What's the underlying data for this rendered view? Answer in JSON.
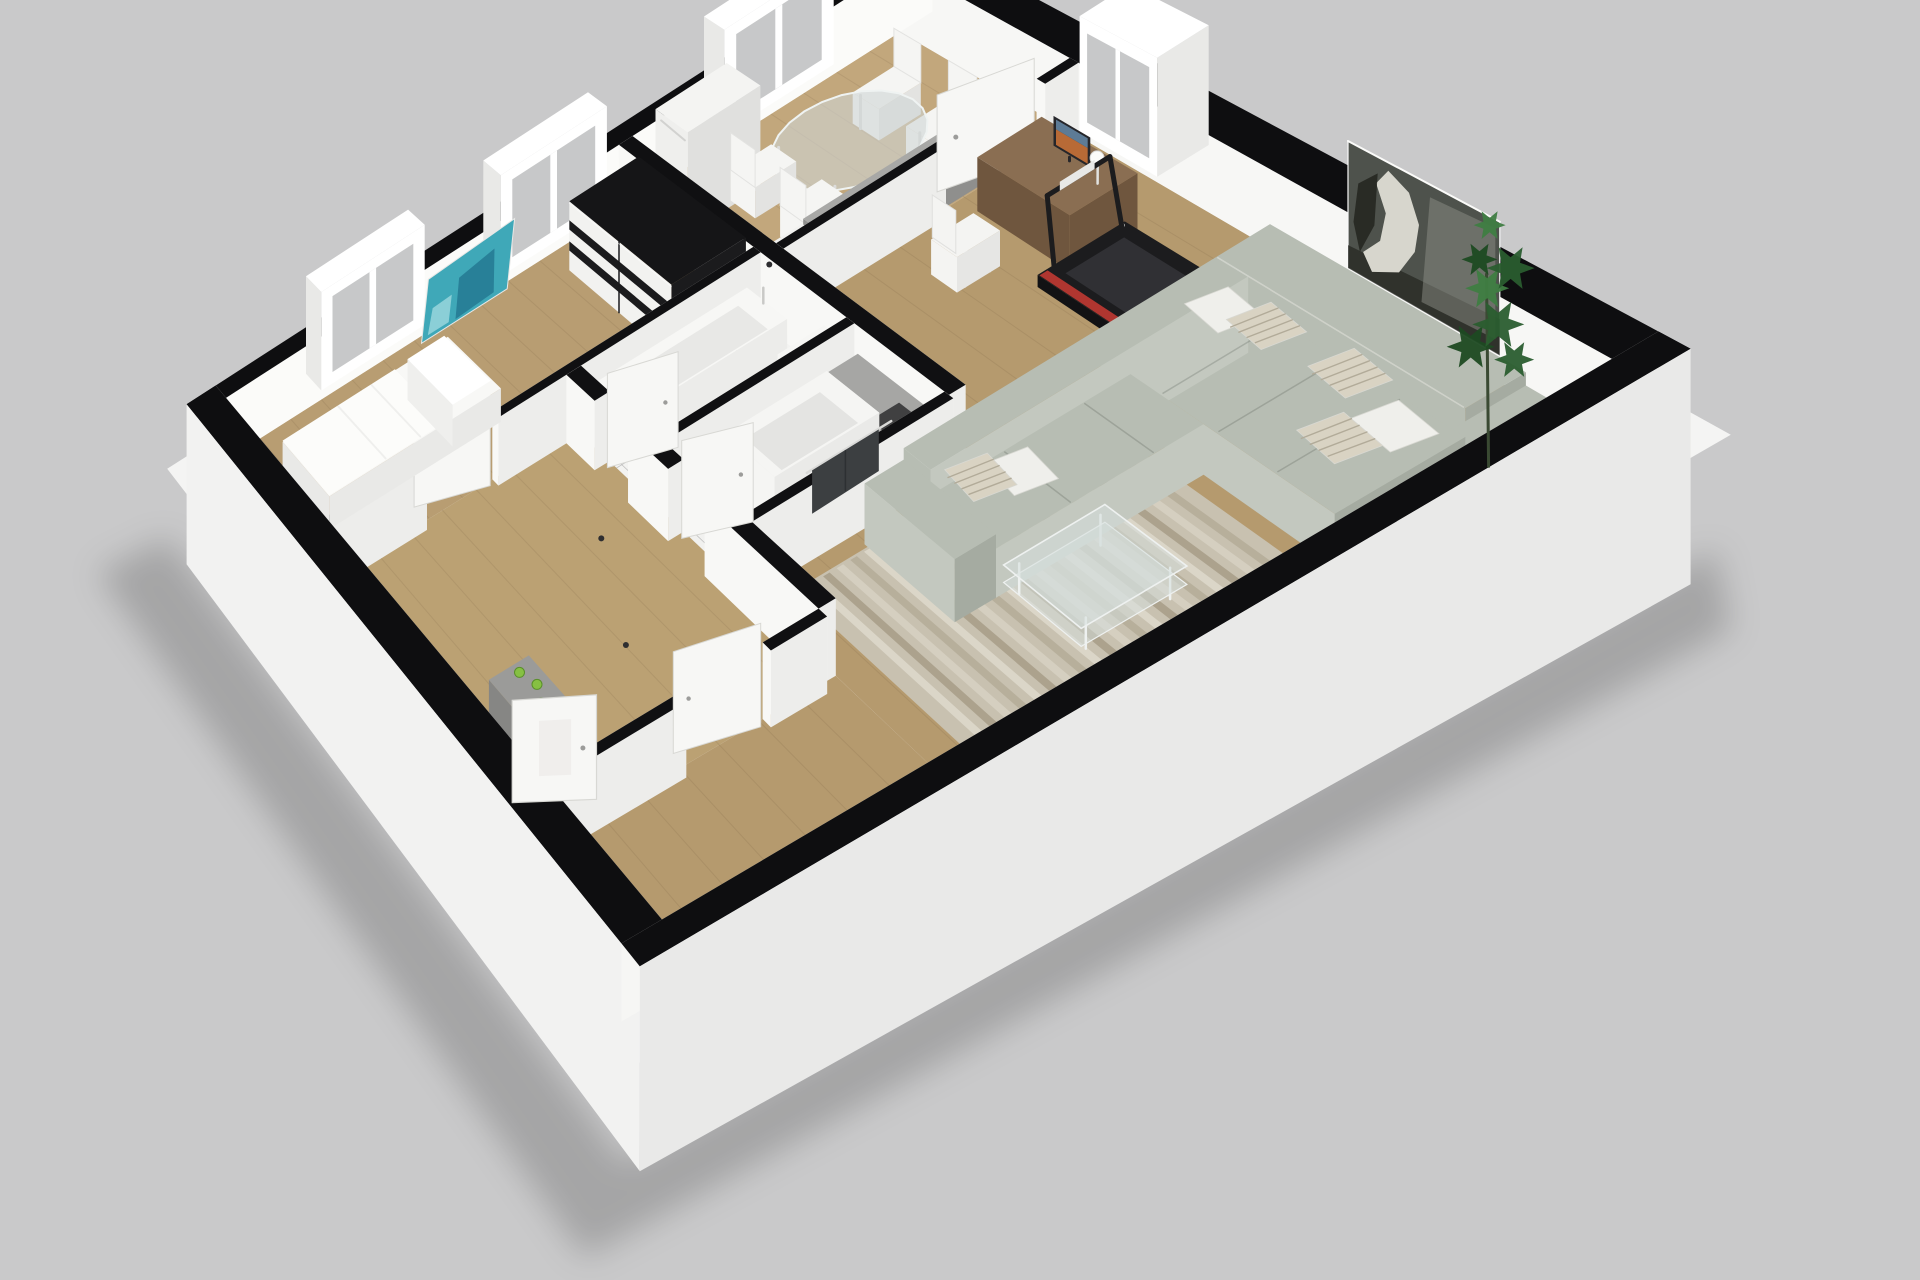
{
  "meta": {
    "scene": "apartment-3d-floor-plan",
    "style": "dollhouse-isometric-render",
    "background": "#c9c9ca"
  },
  "rooms": [
    {
      "name": "living-room",
      "floor": "wood"
    },
    {
      "name": "kitchen-dining",
      "floor": "wood"
    },
    {
      "name": "bedroom",
      "floor": "wood"
    },
    {
      "name": "bathroom",
      "floor": "tile"
    },
    {
      "name": "shower-room",
      "floor": "tile"
    },
    {
      "name": "hallway",
      "floor": "wood"
    }
  ],
  "furniture_by_room": {
    "living-room": [
      "sectional-sofa",
      "pillows",
      "area-rug",
      "coffee-table",
      "treadmill",
      "desk",
      "monitor",
      "desk-lamp",
      "office-chair",
      "horse-painting",
      "potted-plant"
    ],
    "kitchen-dining": [
      "refrigerator",
      "dining-table",
      "dining-chairs",
      "kitchen-counter",
      "kitchen-cabinet"
    ],
    "bedroom": [
      "wardrobe",
      "bed",
      "wall-art-teal"
    ],
    "bathroom": [
      "bathtub",
      "bathroom-sink"
    ],
    "shower-room": [
      "shower",
      "towel",
      "vanity-counter",
      "toilet"
    ],
    "hallway": [
      "entry-shelf",
      "decor-apples",
      "doors"
    ]
  },
  "counts": {
    "windows_nw": 3,
    "windows_ne": 1,
    "doors": 6,
    "pillows": 7,
    "apples": 3
  },
  "palette": {
    "background": "#c9c9ca",
    "wall_top": "#0e0e10",
    "wall_face": "#f8f8f6",
    "wall_face_shade": "#ededeb",
    "glass": "#c7c8c9"
  },
  "objects": {
    "foundation-slab": {
      "color": "#f4f4f3"
    },
    "ground-shadow": {
      "color": "rgba(0,0,0,0.18)"
    },
    "outer-wall-nw": {
      "top": "#0e0e10",
      "inner": "#fbfbf9"
    },
    "outer-wall-ne": {
      "top": "#0e0e10",
      "inner": "#f7f7f5"
    },
    "outer-wall-sw": {
      "top": "#0e0e10",
      "outer": "#f2f2f1",
      "inner": "#f8f8f6"
    },
    "outer-wall-se": {
      "top": "#0e0e10",
      "outer": "#e9e9e8",
      "inner": "#f6f6f4"
    },
    "interior-wall": {
      "top": "#101012",
      "face": "#f8f8f6",
      "shade": "#ededeb"
    },
    "floor-kitchen": {
      "color": "#c2a77c"
    },
    "floor-living": {
      "color": "#b59a6e"
    },
    "floor-bedroom": {
      "color": "#b89d72"
    },
    "floor-hallway": {
      "color": "#bba173"
    },
    "floor-bathroom": {
      "color": "#f3f3f1"
    },
    "floor-shower-room": {
      "color": "#f1f1ef"
    },
    "window": {
      "frame": "#ffffff",
      "glass": "#c7c8c9",
      "edge": "#e9e9e7"
    },
    "door": {
      "panel": "#f7f7f5",
      "edge": "#d8d8d4",
      "handle": "#9c9c9a"
    },
    "refrigerator": {
      "top": "#f4f4f2",
      "front": "#efefed",
      "side": "#e0e0de"
    },
    "dining-table": {
      "glass": "rgba(206,214,213,0.6)",
      "rim": "#eff3f2",
      "leg": "#dcdcda"
    },
    "dining-chair": {
      "color": "#f5f5f3",
      "shade": "#e3e3e1"
    },
    "kitchen-counter": {
      "top": "#a8a8a6",
      "side": "#8f8f8d"
    },
    "kitchen-cabinet": {
      "top": "#f1f1ef",
      "front": "#e8e8e6",
      "panel": "#3a3a3c"
    },
    "desk": {
      "top": "#8a6e52",
      "side": "#6f563e"
    },
    "office-chair": {
      "color": "#f4f4f2",
      "base": "#d9d9d7"
    },
    "monitor": {
      "frame": "#26262a",
      "screen": "#b86a36",
      "screen_top": "#5d7b96"
    },
    "desk-lamp": {
      "color": "#fbfbf9"
    },
    "treadmill": {
      "deck": "#1c1c1e",
      "belt": "#303034",
      "side": "#121214",
      "accent": "#b03630",
      "detail": "#e8e8e6"
    },
    "sectional-sofa": {
      "top": "#b7bdb3",
      "front": "#c3c8bf",
      "side": "#a5aba1",
      "seam": "rgba(40,45,38,0.18)"
    },
    "pillow": {
      "plain": "#efefeb",
      "striped": "#d9d3c3",
      "stripe": "#b2ab99"
    },
    "area-rug": {
      "base": "#c8c1b0",
      "stripes": [
        "#b5ad99",
        "#d6d0c2",
        "#a99f8a",
        "#ddd8cb"
      ]
    },
    "coffee-table": {
      "glass": "rgba(214,222,220,0.55)",
      "frame": "#eef1f0"
    },
    "horse-painting": {
      "canvas": "#4e524c",
      "horse": "#d7d6cd",
      "dark": "#23251f",
      "mid": "#8b8d85"
    },
    "potted-plant": {
      "leaf": "#2a5d2f",
      "leaf_light": "#3f7d42",
      "leaf_dark": "#1d4a22",
      "stem": "#3a4a33"
    },
    "wardrobe": {
      "top": "#151517",
      "front": "#f2f2f0",
      "band": "#1b1b1d",
      "side": "#1b1b1d"
    },
    "bed": {
      "mattress": "#f8f8f6",
      "duvet": "#fcfcfa",
      "side": "#e9e9e7",
      "pillow": "#ffffff"
    },
    "wall-art-teal": {
      "main": "#3fa8b8",
      "dark": "#1f6f8a",
      "light": "#9fd8de"
    },
    "bathtub": {
      "rim": "#f7f7f5",
      "basin": "#e8e8e6",
      "side": "#ececea"
    },
    "bathroom-sink": {
      "color": "#f6f6f4"
    },
    "shower": {
      "wall": "#f5f5f3",
      "inner": "#e4e4e2",
      "side": "#eaeae8"
    },
    "towel": {
      "color": "#3c3f41",
      "rail": "#d9d9d7"
    },
    "vanity-counter": {
      "top": "#a6a6a4",
      "side": "#8e8e8c"
    },
    "toilet": {
      "color": "#f5f5f3"
    },
    "entry-shelf": {
      "color": "#9b9b99",
      "side": "#868684"
    },
    "decor-apple": {
      "color": "#86c043",
      "edge": "#5a8f2a"
    },
    "floor-spot": {
      "color": "#2e2e30"
    }
  }
}
